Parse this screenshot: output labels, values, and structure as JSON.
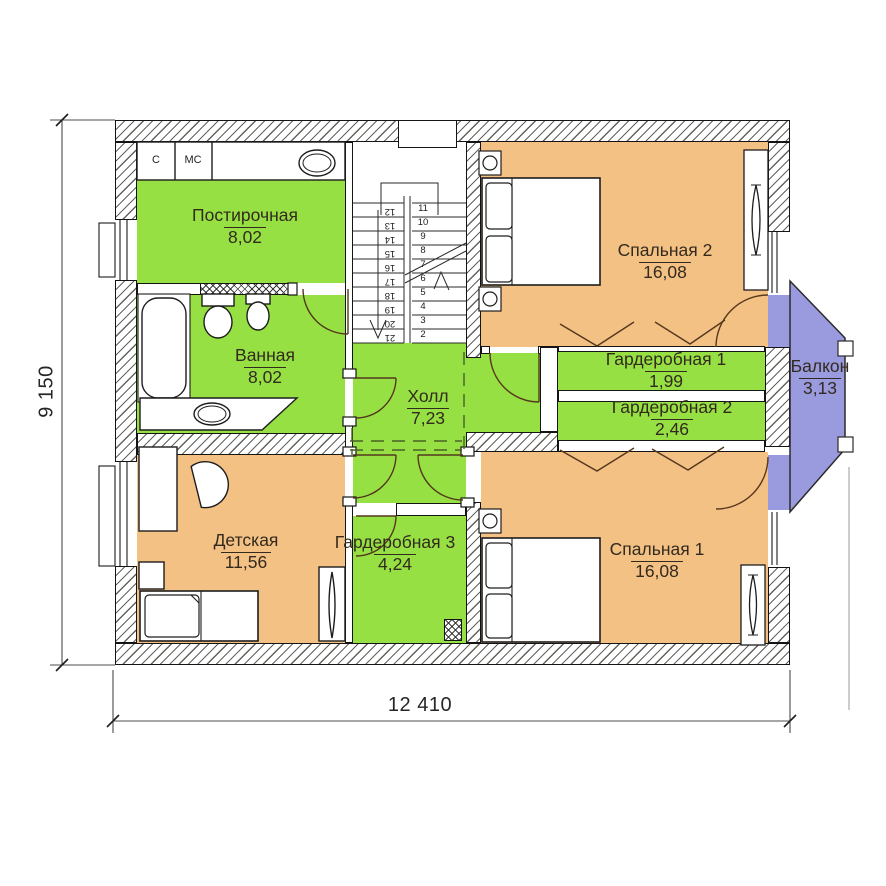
{
  "rooms": [
    {
      "id": "laundry",
      "name": "Постирочная",
      "area": "8,02"
    },
    {
      "id": "bathroom",
      "name": "Ванная",
      "area": "8,02"
    },
    {
      "id": "hall",
      "name": "Холл",
      "area": "7,23"
    },
    {
      "id": "bedroom2",
      "name": "Спальная 2",
      "area": "16,08"
    },
    {
      "id": "wardrobe1",
      "name": "Гардеробная 1",
      "area": "1,99"
    },
    {
      "id": "wardrobe2",
      "name": "Гардеробная 2",
      "area": "2,46"
    },
    {
      "id": "balcony",
      "name": "Балкон",
      "area": "3,13"
    },
    {
      "id": "kids",
      "name": "Детская",
      "area": "11,56"
    },
    {
      "id": "wardrobe3",
      "name": "Гардеробная 3",
      "area": "4,24"
    },
    {
      "id": "bedroom1",
      "name": "Спальная 1",
      "area": "16,08"
    }
  ],
  "dimensions": {
    "vertical": "9 150",
    "horizontal": "12 410"
  },
  "appliance_labels": {
    "washer": "С",
    "dryer": "МС"
  },
  "stairs": {
    "right_numbers": [
      "11",
      "10",
      "9",
      "8",
      "7",
      "6",
      "5",
      "4",
      "3",
      "2"
    ],
    "left_numbers": [
      "12",
      "13",
      "14",
      "15",
      "16",
      "17",
      "18",
      "19",
      "20",
      "21"
    ]
  },
  "colors": {
    "room_green": "#97e043",
    "room_orange": "#f4c184",
    "balcony_blue": "#9a9ade",
    "wall_line": "#141414",
    "label_text": "#322a1e"
  }
}
